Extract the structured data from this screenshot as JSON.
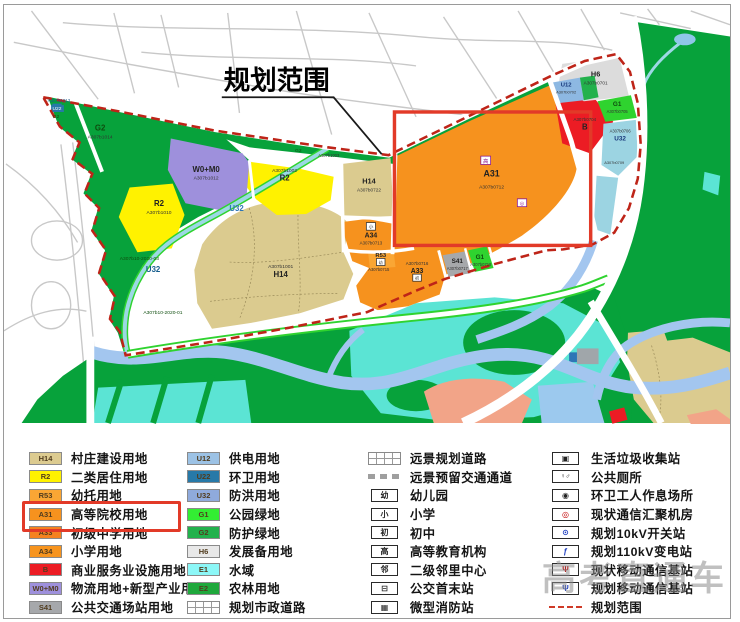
{
  "map": {
    "title": "规划范围",
    "colors": {
      "boundary_dash": "#be2418",
      "highlight_box": "#e23a28",
      "green_main": "#07a23b",
      "green_bright": "#2fd32f",
      "tan_h14": "#dbcb8f",
      "yellow_r2": "#fff200",
      "purple_w0m0": "#9e90dc",
      "orange_a31": "#f6921e",
      "red_b": "#ec1c24",
      "water_river": "#a3c6ef",
      "water_marsh": "#5be4d4"
    },
    "labels": [
      {
        "t": "A307b1013",
        "x": 56,
        "y": 97,
        "s": 4.5,
        "c": "#1d5a8c"
      },
      {
        "t": "U22",
        "x": 54,
        "y": 105,
        "s": 5,
        "c": "#ffffff",
        "bg": "#2779a8"
      },
      {
        "t": "G2",
        "x": 53,
        "y": 113,
        "s": 5,
        "c": "#0e4d0e"
      },
      {
        "t": "G2",
        "x": 98,
        "y": 126,
        "s": 8,
        "c": "#0e4d0e",
        "b": 1
      },
      {
        "t": "A307b1014",
        "x": 98,
        "y": 134,
        "s": 5,
        "c": "#333333"
      },
      {
        "t": "W0+M0",
        "x": 206,
        "y": 168,
        "s": 8,
        "c": "#222222",
        "b": 1
      },
      {
        "t": "A307b1012",
        "x": 206,
        "y": 176,
        "s": 5,
        "c": "#333333"
      },
      {
        "t": "R2",
        "x": 158,
        "y": 203,
        "s": 8,
        "c": "#222222",
        "b": 1
      },
      {
        "t": "A307b1010",
        "x": 158,
        "y": 211,
        "s": 5,
        "c": "#333333"
      },
      {
        "t": "A307b1002",
        "x": 286,
        "y": 168,
        "s": 5,
        "c": "#333333"
      },
      {
        "t": "R2",
        "x": 286,
        "y": 177,
        "s": 8,
        "c": "#222222",
        "b": 1
      },
      {
        "t": "A307b1001",
        "x": 282,
        "y": 266,
        "s": 5,
        "c": "#333333"
      },
      {
        "t": "H14",
        "x": 282,
        "y": 275,
        "s": 8,
        "c": "#222222",
        "b": 1
      },
      {
        "t": "H14",
        "x": 372,
        "y": 180,
        "s": 7.5,
        "c": "#222222",
        "b": 1
      },
      {
        "t": "A307b0722",
        "x": 372,
        "y": 188,
        "s": 4.8,
        "c": "#333333"
      },
      {
        "t": "高",
        "x": 491,
        "y": 159,
        "s": 5.5,
        "c": "#8b1a8b",
        "box": 1
      },
      {
        "t": "A31",
        "x": 497,
        "y": 173,
        "s": 9,
        "c": "#222222",
        "b": 1
      },
      {
        "t": "A307b0712",
        "x": 497,
        "y": 185,
        "s": 5,
        "c": "#333333"
      },
      {
        "t": "◎",
        "x": 528,
        "y": 202,
        "s": 5,
        "c": "#8b1a8b",
        "box": 1
      },
      {
        "t": "小",
        "x": 374,
        "y": 226,
        "s": 4.8,
        "c": "#333333",
        "box": 1
      },
      {
        "t": "A34",
        "x": 374,
        "y": 235,
        "s": 7,
        "c": "#222222",
        "b": 1
      },
      {
        "t": "A307b0713",
        "x": 374,
        "y": 242,
        "s": 4.5,
        "c": "#333333"
      },
      {
        "t": "R53",
        "x": 384,
        "y": 255,
        "s": 6,
        "c": "#222222",
        "b": 1
      },
      {
        "t": "幼",
        "x": 384,
        "y": 262,
        "s": 4.2,
        "c": "#333333",
        "box": 1
      },
      {
        "t": "A307b0715",
        "x": 382,
        "y": 269,
        "s": 4.2,
        "c": "#333333"
      },
      {
        "t": "A307b0716",
        "x": 421,
        "y": 263,
        "s": 4.5,
        "c": "#333333"
      },
      {
        "t": "A33",
        "x": 421,
        "y": 271,
        "s": 7,
        "c": "#222222",
        "b": 1
      },
      {
        "t": "初",
        "x": 421,
        "y": 278,
        "s": 4.2,
        "c": "#333333",
        "box": 1
      },
      {
        "t": "S41",
        "x": 462,
        "y": 261,
        "s": 6.5,
        "c": "#222222",
        "b": 1
      },
      {
        "t": "A307b0717",
        "x": 462,
        "y": 268,
        "s": 4.2,
        "c": "#333333"
      },
      {
        "t": "G1",
        "x": 485,
        "y": 257,
        "s": 6.5,
        "c": "#0e4d0e",
        "b": 1
      },
      {
        "t": "A307b0718",
        "x": 486,
        "y": 264,
        "s": 4.2,
        "c": "#333333"
      },
      {
        "t": "A307b0704",
        "x": 592,
        "y": 116,
        "s": 4.5,
        "c": "#333333"
      },
      {
        "t": "B",
        "x": 592,
        "y": 125,
        "s": 8,
        "c": "#222222",
        "b": 1
      },
      {
        "t": "G1",
        "x": 625,
        "y": 101,
        "s": 6.5,
        "c": "#0e4d0e",
        "b": 1
      },
      {
        "t": "A307b0705",
        "x": 625,
        "y": 108,
        "s": 4.2,
        "c": "#333333"
      },
      {
        "t": "H6",
        "x": 603,
        "y": 71,
        "s": 7.5,
        "c": "#222222",
        "b": 1
      },
      {
        "t": "A307b0701",
        "x": 603,
        "y": 79,
        "s": 4.8,
        "c": "#333333"
      },
      {
        "t": "U12",
        "x": 573,
        "y": 81,
        "s": 6,
        "c": "#17377a",
        "b": 1
      },
      {
        "t": "A307b0702",
        "x": 573,
        "y": 88,
        "s": 4,
        "c": "#333333"
      },
      {
        "t": "A307b0706",
        "x": 628,
        "y": 128,
        "s": 4.2,
        "c": "#333333"
      },
      {
        "t": "U32",
        "x": 628,
        "y": 136,
        "s": 6.5,
        "c": "#17377a",
        "b": 1
      },
      {
        "t": "A307b0709",
        "x": 622,
        "y": 160,
        "s": 4,
        "c": "#333333"
      },
      {
        "t": "U32",
        "x": 237,
        "y": 208,
        "s": 8,
        "c": "#2e75b6",
        "b": 1
      },
      {
        "t": "U32",
        "x": 152,
        "y": 270,
        "s": 8,
        "c": "#145c8c",
        "b": 1
      },
      {
        "t": "A307b10-2020-03",
        "x": 138,
        "y": 258,
        "s": 5,
        "c": "#0e4d0e"
      },
      {
        "t": "A307b10-2020-01",
        "x": 162,
        "y": 313,
        "s": 5,
        "c": "#0e4d0e"
      },
      {
        "t": "G2",
        "x": 300,
        "y": 148,
        "s": 5,
        "c": "#0e4d0e"
      },
      {
        "t": "A307b1003",
        "x": 331,
        "y": 153,
        "s": 4.2,
        "c": "#333333"
      }
    ]
  },
  "legend": {
    "columns": [
      {
        "items": [
          {
            "code": "H14",
            "color": "#dccb90",
            "label": "村庄建设用地"
          },
          {
            "code": "R2",
            "color": "#fff200",
            "label": "二类居住用地"
          },
          {
            "code": "R53",
            "color": "#faa634",
            "label": "幼托用地"
          },
          {
            "code": "A31",
            "color": "#f6921e",
            "label": "高等院校用地",
            "highlighted": true
          },
          {
            "code": "A33",
            "color": "#f58220",
            "label": "初级中学用地"
          },
          {
            "code": "A34",
            "color": "#f7941e",
            "label": "小学用地"
          },
          {
            "code": "B",
            "color": "#ec1c24",
            "label": "商业服务业设施用地"
          },
          {
            "code": "W0+M0",
            "color": "#9e90dc",
            "label": "物流用地+新型产业用地"
          },
          {
            "code": "S41",
            "color": "#a6a8ab",
            "label": "公共交通场站用地"
          }
        ]
      },
      {
        "items": [
          {
            "code": "U12",
            "color": "#9cc2e5",
            "label": "供电用地"
          },
          {
            "code": "U22",
            "color": "#2779a8",
            "label": "环卫用地"
          },
          {
            "code": "U32",
            "color": "#8faadc",
            "label": "防洪用地"
          },
          {
            "code": "G1",
            "color": "#33ee33",
            "label": "公园绿地"
          },
          {
            "code": "G2",
            "color": "#22b14c",
            "label": "防护绿地"
          },
          {
            "code": "H6",
            "color": "#e8e8e8",
            "label": "发展备用地"
          },
          {
            "code": "E1",
            "color": "#8cf7f7",
            "label": "水域"
          },
          {
            "code": "E2",
            "color": "#1fa83c",
            "label": "农林用地"
          },
          {
            "type": "road-hatch",
            "icon": "planned-road-icon",
            "label": "规划市政道路"
          }
        ]
      },
      {
        "items": [
          {
            "type": "road-hatch",
            "icon": "future-road-icon",
            "label": "远景规划道路"
          },
          {
            "type": "dash",
            "icon": "reserved-corridor-icon",
            "label": "远景预留交通通道"
          },
          {
            "glyph": "幼",
            "icon": "kindergarten-icon",
            "label": "幼儿园"
          },
          {
            "glyph": "小",
            "icon": "primary-school-icon",
            "label": "小学"
          },
          {
            "glyph": "初",
            "icon": "middle-school-icon",
            "label": "初中"
          },
          {
            "glyph": "高",
            "icon": "higher-education-icon",
            "label": "高等教育机构"
          },
          {
            "glyph": "邻",
            "icon": "neighborhood-center-icon",
            "label": "二级邻里中心"
          },
          {
            "pict": "bus",
            "icon": "bus-terminus-icon",
            "label": "公交首末站"
          },
          {
            "pict": "fire",
            "icon": "fire-station-icon",
            "label": "微型消防站"
          }
        ]
      },
      {
        "items": [
          {
            "pict": "trash",
            "icon": "trash-collection-icon",
            "label": "生活垃圾收集站"
          },
          {
            "pict": "toilet",
            "icon": "public-toilet-icon",
            "label": "公共厕所"
          },
          {
            "pict": "rest",
            "icon": "sanitation-rest-icon",
            "label": "环卫工人作息场所"
          },
          {
            "pict": "comm",
            "color": "#c00000",
            "icon": "comm-hub-room-icon",
            "label": "现状通信汇聚机房"
          },
          {
            "pict": "switch",
            "color": "#2040c0",
            "icon": "switch-station-10kv-icon",
            "label": "规划10kV开关站"
          },
          {
            "pict": "substation",
            "color": "#2040c0",
            "icon": "substation-110kv-icon",
            "label": "规划110kV变电站"
          },
          {
            "pict": "antenna",
            "color": "#c00000",
            "icon": "mobile-base-existing-icon",
            "label": "现状移动通信基站"
          },
          {
            "pict": "antenna",
            "color": "#2040c0",
            "icon": "mobile-base-planned-icon",
            "label": "规划移动通信基站"
          },
          {
            "type": "boundary",
            "icon": "planning-boundary-icon",
            "label": "规划范围"
          }
        ]
      }
    ]
  },
  "watermark": "高考直通车"
}
